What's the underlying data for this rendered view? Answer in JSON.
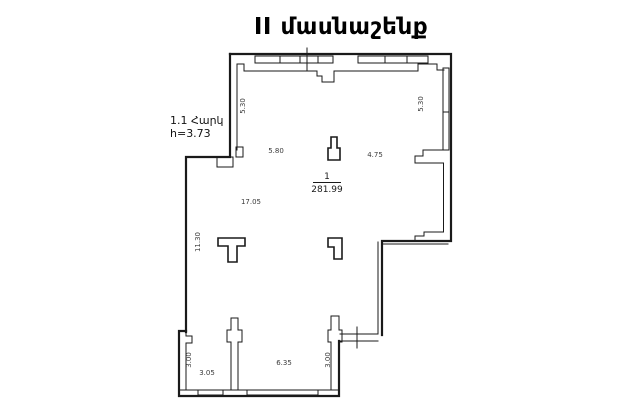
{
  "title": "II մասնաշենք",
  "colors": {
    "wall": "#1a1a1a",
    "dim_text": "#3a3a3a",
    "background": "#ffffff"
  },
  "floor_info": {
    "floor": "1.1 Հարկ",
    "height": "h=3.73"
  },
  "room": {
    "number": "1",
    "area": "281.99"
  },
  "dimensions": {
    "upper_left_wall_height": "5.30",
    "upper_right_wall_height": "5.30",
    "upper_left_width": "5.80",
    "upper_right_width": "4.75",
    "hall_width": "17.05",
    "left_wall_height": "11.30",
    "lower_left_pillar": "3.00",
    "lower_left_width": "3.05",
    "lower_middle_width": "6.35",
    "lower_right_pillar": "3.00"
  }
}
